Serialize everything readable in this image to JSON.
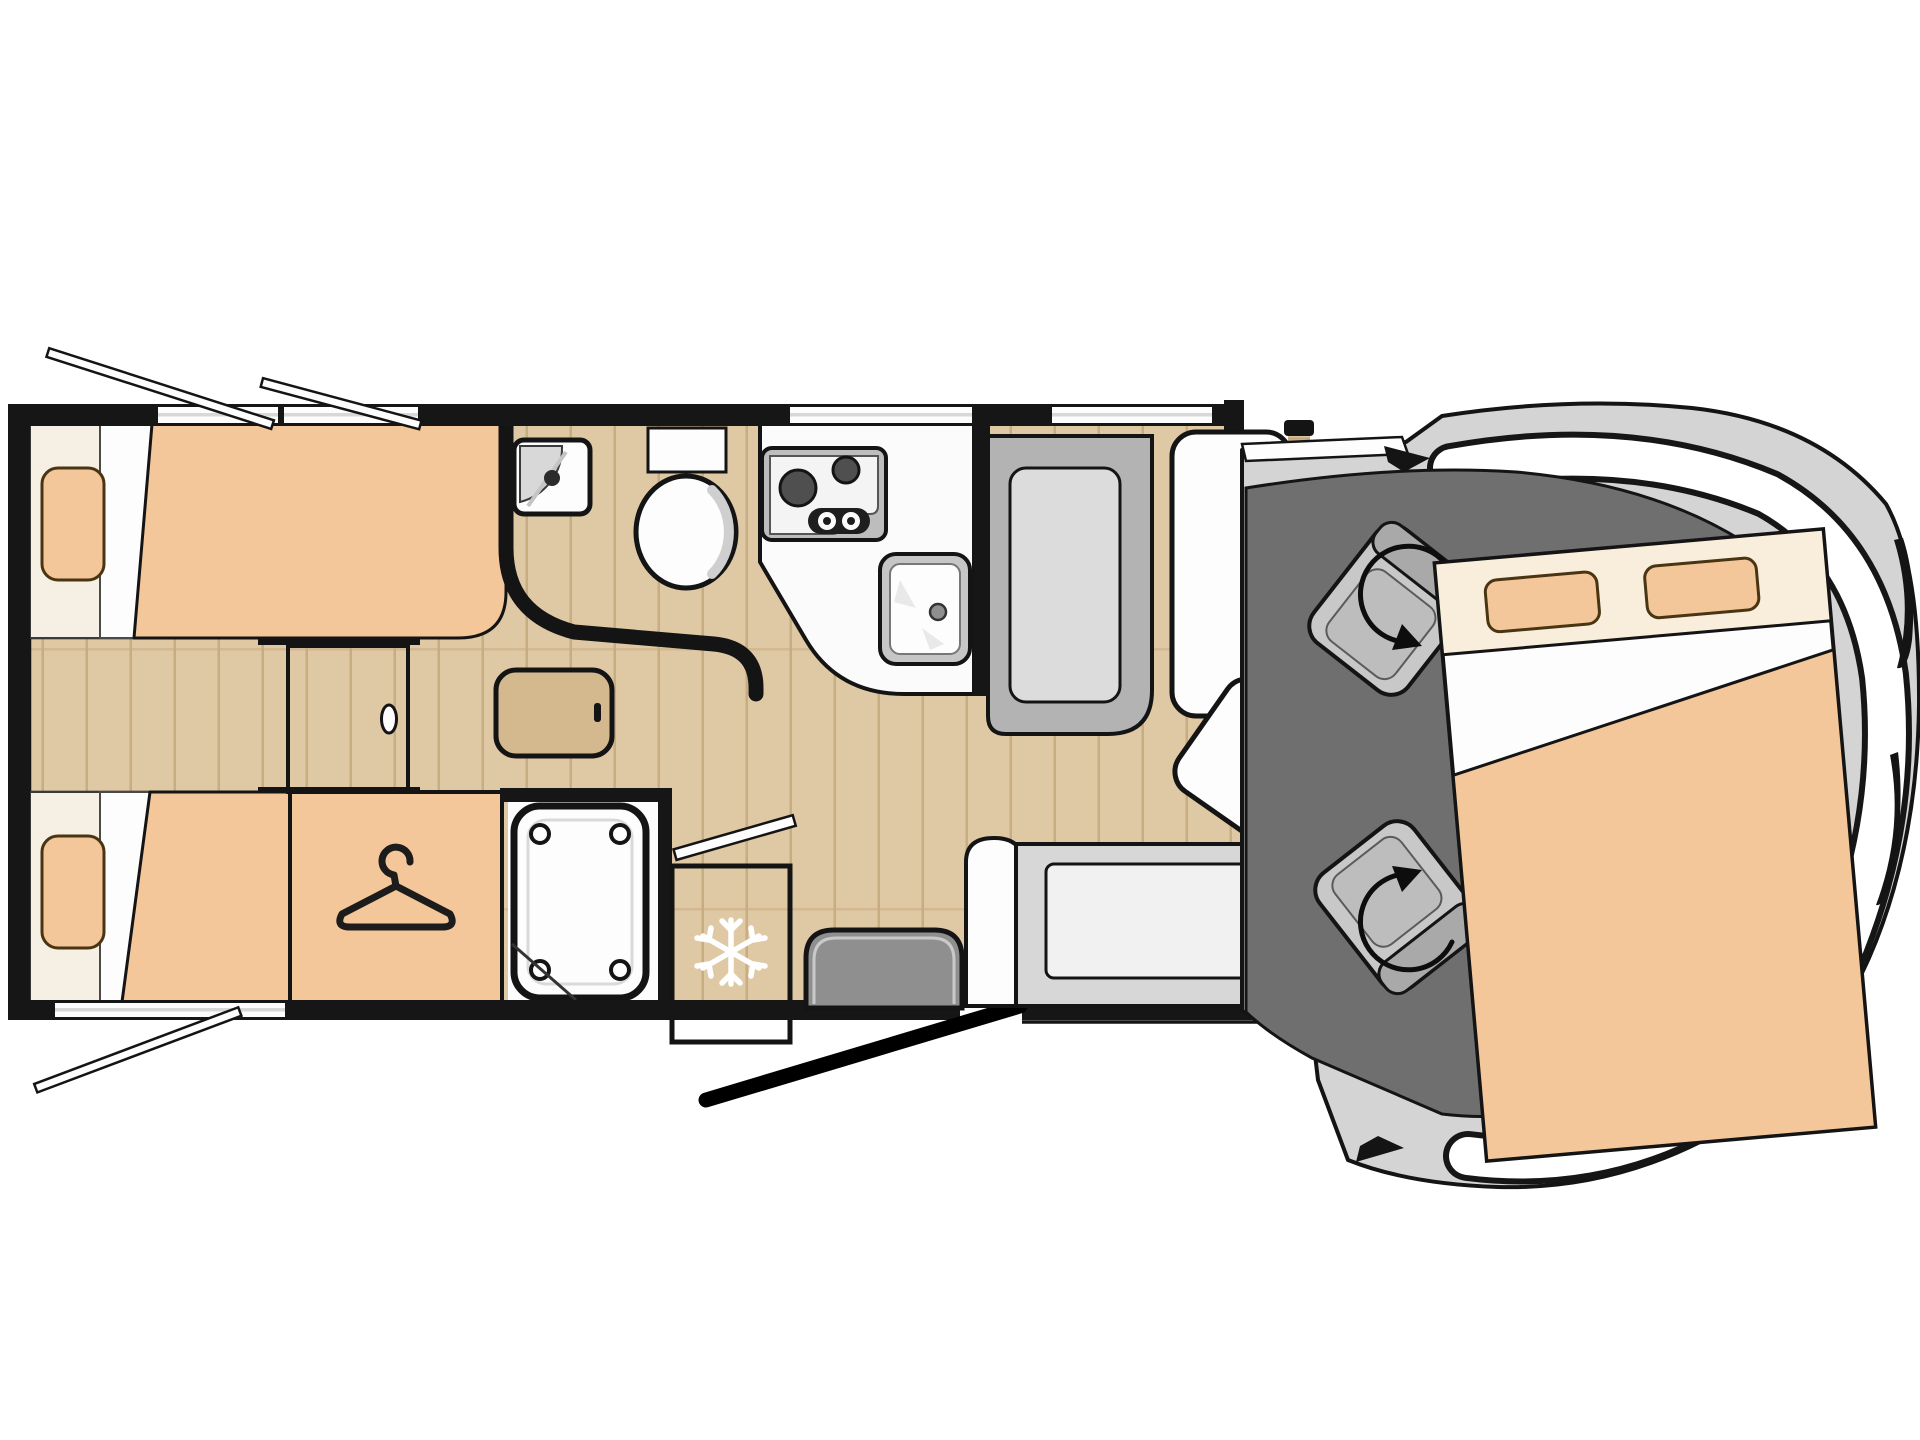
{
  "diagram": {
    "type": "motorhome-floorplan",
    "orientation": "side-view-top-down, cab at right, rear at left"
  },
  "icons": {
    "wardrobe": "hanger-icon",
    "refrigerator": "snowflake-icon",
    "cab_seats": "rotation-arrow-icon",
    "windows": "open-window-stay",
    "entry": "open-door-swing"
  },
  "elements": [
    "rear-single-bed-top",
    "rear-single-bed-bottom",
    "bed-pillow",
    "rear-walkway-step",
    "sliding-door",
    "wardrobe",
    "bedside-table",
    "washroom",
    "corner-basin",
    "toilet",
    "shower-cabin",
    "shower-tray",
    "kitchen-counter",
    "hob",
    "kitchen-sink",
    "refrigerator",
    "dinette-bench",
    "dinette-table",
    "table-swivel-extension",
    "entry-seat",
    "entry-door",
    "side-sofa",
    "cab-floor",
    "swivel-cab-seat-left",
    "swivel-cab-seat-right",
    "drop-down-bed",
    "vehicle-cab-body",
    "windshield"
  ],
  "colors": {
    "background": "#ffffff",
    "wall": "#161616",
    "outline_black": "#141414",
    "wood_floor": "#dfc8a4",
    "wood_plank_line": "#c8ac82",
    "walkway_dark": "#7a7165",
    "walkway_grain": "#665e53",
    "walkway_light_grain": "#8d8476",
    "door_wood": "#dac29d",
    "door_wood_grain": "#c3a77e",
    "upholstery_peach": "#f4c79b",
    "bed_sheet_cream": "#f6efe3",
    "bed_header_cream": "#f9eedb",
    "pillow_border": "#4a3513",
    "fridge_wood": "#5e574e",
    "fridge_grain": "#4d473f",
    "snowflake_white": "#ffffff",
    "counter_white": "#fbfbfb",
    "appliance_gray": "#bdbdbd",
    "burner_dark": "#4f4f4f",
    "bench_gray": "#b3b3b3",
    "bench_panel": "#dcdcdc",
    "table_white": "#fdfdfd",
    "wood_table": "#d4b98f",
    "sofa_shell": "#d7d7d7",
    "sofa_cushion": "#f1f1f1",
    "entry_seat_gray": "#8f8f8f",
    "cab_floor": "#6f6f6f",
    "cab_seat": "#c8c8c8",
    "cab_seat_back": "#a9a9a9",
    "vehicle_body": "#d4d4d4",
    "windshield_white": "#ffffff",
    "window_glass": "#d8d8d8"
  }
}
